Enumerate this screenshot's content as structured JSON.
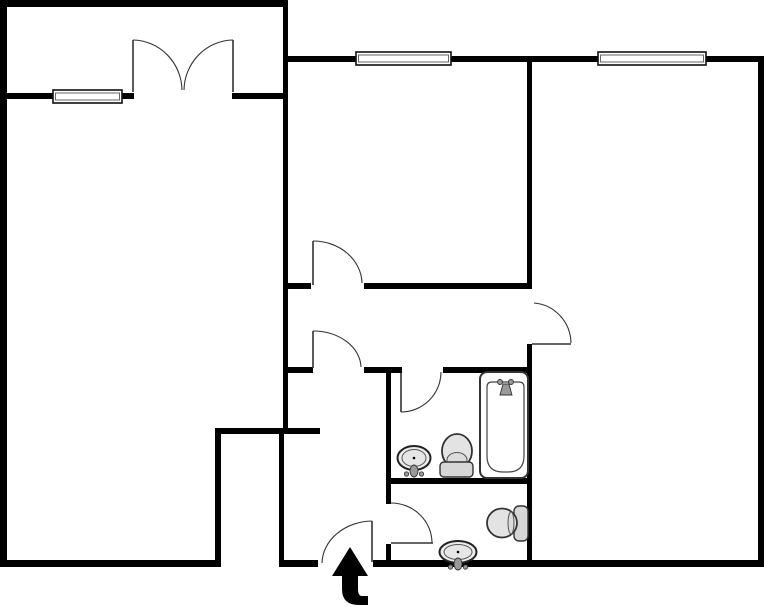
{
  "meta": {
    "title": "apartment-floor-plan",
    "canvas": {
      "w": 764,
      "h": 607
    },
    "background": "#ffffff"
  },
  "colors": {
    "wall": "#000000",
    "door_line": "#333333",
    "window_fill": "#ffffff",
    "window_stroke": "#111111",
    "window_inner": "#666666",
    "fixture_stroke": "#333333",
    "fixture_fill": "#e3e3e3",
    "fixture_fill_light": "#ececec",
    "metal": "#999999",
    "arrow": "#000000"
  },
  "walls": [
    {
      "x": 0,
      "y": 0,
      "w": 288,
      "h": 7
    },
    {
      "x": 0,
      "y": 0,
      "w": 7,
      "h": 567
    },
    {
      "x": 7,
      "y": 93,
      "w": 46,
      "h": 6
    },
    {
      "x": 122,
      "y": 93,
      "w": 12,
      "h": 6
    },
    {
      "x": 232,
      "y": 93,
      "w": 51,
      "h": 6
    },
    {
      "x": 283,
      "y": 56,
      "w": 73,
      "h": 6
    },
    {
      "x": 451,
      "y": 56,
      "w": 147,
      "h": 6
    },
    {
      "x": 706,
      "y": 56,
      "w": 58,
      "h": 6
    },
    {
      "x": 758,
      "y": 56,
      "w": 6,
      "h": 511
    },
    {
      "x": 0,
      "y": 560,
      "w": 220,
      "h": 7
    },
    {
      "x": 279,
      "y": 560,
      "w": 39,
      "h": 7
    },
    {
      "x": 373,
      "y": 560,
      "w": 391,
      "h": 7
    },
    {
      "x": 283,
      "y": 0,
      "w": 5,
      "h": 434
    },
    {
      "x": 215,
      "y": 428,
      "w": 105,
      "h": 6
    },
    {
      "x": 215,
      "y": 430,
      "w": 6,
      "h": 137
    },
    {
      "x": 279,
      "y": 430,
      "w": 5,
      "h": 137
    },
    {
      "x": 527,
      "y": 56,
      "w": 5,
      "h": 231
    },
    {
      "x": 527,
      "y": 344,
      "w": 5,
      "h": 223
    },
    {
      "x": 283,
      "y": 283,
      "w": 28,
      "h": 6
    },
    {
      "x": 364,
      "y": 283,
      "w": 168,
      "h": 6
    },
    {
      "x": 283,
      "y": 367,
      "w": 30,
      "h": 6
    },
    {
      "x": 364,
      "y": 367,
      "w": 38,
      "h": 6
    },
    {
      "x": 443,
      "y": 367,
      "w": 89,
      "h": 6
    },
    {
      "x": 386,
      "y": 367,
      "w": 5,
      "h": 137
    },
    {
      "x": 386,
      "y": 544,
      "w": 5,
      "h": 23
    },
    {
      "x": 386,
      "y": 478,
      "w": 146,
      "h": 6
    }
  ],
  "windows": [
    {
      "name": "balcony-window",
      "x": 53,
      "y": 90,
      "w": 69,
      "h": 13
    },
    {
      "name": "middle-room-window",
      "x": 356,
      "y": 52,
      "w": 95,
      "h": 13
    },
    {
      "name": "right-room-window",
      "x": 598,
      "y": 52,
      "w": 108,
      "h": 13
    }
  ],
  "doors": [
    {
      "name": "balcony-door-left",
      "leaf": [
        133,
        92,
        133,
        40
      ],
      "arc": {
        "from": [
          133,
          40
        ],
        "to": [
          182,
          90
        ],
        "rx": 50,
        "ry": 51,
        "sweep": 1
      }
    },
    {
      "name": "balcony-door-right",
      "leaf": [
        233,
        92,
        233,
        40
      ],
      "arc": {
        "from": [
          233,
          40
        ],
        "to": [
          184,
          90
        ],
        "rx": 50,
        "ry": 51,
        "sweep": 0
      }
    },
    {
      "name": "middle-room-door",
      "leaf": [
        313,
        285,
        313,
        241
      ],
      "arc": {
        "from": [
          313,
          241
        ],
        "to": [
          362,
          283
        ],
        "rx": 49,
        "ry": 43,
        "sweep": 1
      }
    },
    {
      "name": "corridor-door",
      "leaf": [
        313,
        368,
        313,
        331
      ],
      "arc": {
        "from": [
          313,
          331
        ],
        "to": [
          361,
          367
        ],
        "rx": 48,
        "ry": 37,
        "sweep": 1
      }
    },
    {
      "name": "right-room-door",
      "leaf": [
        532,
        344,
        571,
        344
      ],
      "arc": {
        "from": [
          534,
          303
        ],
        "to": [
          571,
          343
        ],
        "rx": 40,
        "ry": 41,
        "sweep": 1
      }
    },
    {
      "name": "bathroom-door",
      "leaf": [
        401,
        373,
        401,
        412
      ],
      "arc": {
        "from": [
          401,
          412
        ],
        "to": [
          441,
          372
        ],
        "rx": 40,
        "ry": 40,
        "sweep": 0
      }
    },
    {
      "name": "wc-door",
      "leaf": [
        391,
        543,
        433,
        543
      ],
      "arc": {
        "from": [
          391,
          503
        ],
        "to": [
          432,
          543
        ],
        "rx": 41,
        "ry": 40,
        "sweep": 1
      }
    },
    {
      "name": "entrance-door",
      "leaf": [
        372,
        562,
        372,
        521
      ],
      "arc": {
        "from": [
          322,
          563
        ],
        "to": [
          372,
          521
        ],
        "rx": 51,
        "ry": 43,
        "sweep": 1
      }
    }
  ],
  "bathtub": {
    "outer": {
      "x": 480,
      "y": 372,
      "w": 48,
      "h": 106,
      "r": 7
    },
    "inner": {
      "x": 487,
      "y": 382,
      "w": 37,
      "h": 90,
      "rTop": 5,
      "rBottom": 16
    },
    "faucet": {
      "knobs": [
        [
          500,
          382
        ],
        [
          511,
          382
        ]
      ],
      "knobR": 2.5,
      "spout": "503,384 509,384 512,395 500,395"
    }
  },
  "toilets": [
    {
      "name": "bathroom-toilet",
      "orient": "up",
      "tank": {
        "x": 440,
        "y": 462,
        "w": 33,
        "h": 15,
        "r": 4
      },
      "bowl": {
        "cx": 457,
        "cy": 451,
        "rx": 15,
        "ry": 17
      },
      "seat": {
        "cx": 457,
        "cy": 460,
        "rx": 10,
        "ry": 7.5
      }
    },
    {
      "name": "wc-toilet",
      "orient": "left",
      "tank": {
        "x": 514,
        "y": 506,
        "w": 14,
        "h": 35,
        "r": 5
      },
      "bowl": {
        "cx": 502,
        "cy": 523,
        "rx": 15,
        "ry": 14.5
      },
      "seat": {
        "cx": 511,
        "cy": 523,
        "rx": 3,
        "ry": 11
      }
    }
  ],
  "sinks": [
    {
      "name": "bathroom-sink",
      "cx": 414,
      "cy": 458,
      "rx": 16.5,
      "ry": 12
    },
    {
      "name": "wc-sink",
      "cx": 458,
      "cy": 552,
      "rx": 18.5,
      "ry": 11
    }
  ],
  "entrance_arrow": {
    "path": "M350,547 L332,576 L342,576 L342,589 Q342,605 359,605 L368,605 L368,596 L362,596 Q358,596 358,589 L358,576 L368,576 Z"
  }
}
